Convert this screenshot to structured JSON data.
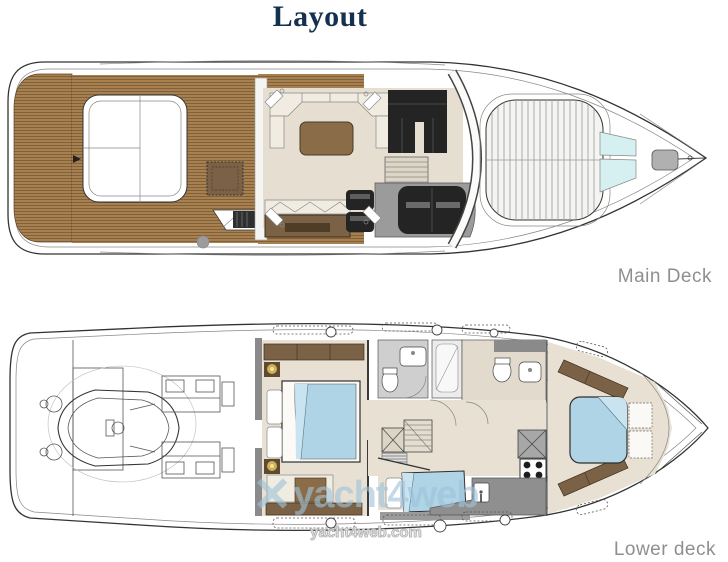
{
  "page": {
    "title": "Layout"
  },
  "decks": {
    "main": {
      "label": "Main Deck"
    },
    "lower": {
      "label": "Lower deck"
    }
  },
  "watermark": {
    "brand": "yacht4web",
    "domain": "yacht4web.com",
    "logo_glyph": "✕"
  },
  "colors": {
    "title_text": "#14324f",
    "deck_label_text": "#8f8f8f",
    "outline_dark": "#333333",
    "line_mid": "#888888",
    "teak": "#a88050",
    "teak_line": "#6f5430",
    "teak_dark": "#7b5c36",
    "wood": "#8a6c49",
    "wood_dark": "#7b6247",
    "floor_salon": "#e6dfd1",
    "floor_cabin": "#e8e1d3",
    "seat_dark": "#242424",
    "seat_cream": "#f1ece1",
    "console_gray": "#9b9b9b",
    "wall_gray": "#8a8a8a",
    "tile_gray": "#cfcfcf",
    "bed_blue": "#aed4e6",
    "bed_blue_light": "#c9e4f0",
    "glass_blue": "#d6f0f2",
    "lamp_glow": "#e9c968",
    "watermark_blue": "#9fc3da",
    "watermark_outline": "#b0b0b0"
  }
}
